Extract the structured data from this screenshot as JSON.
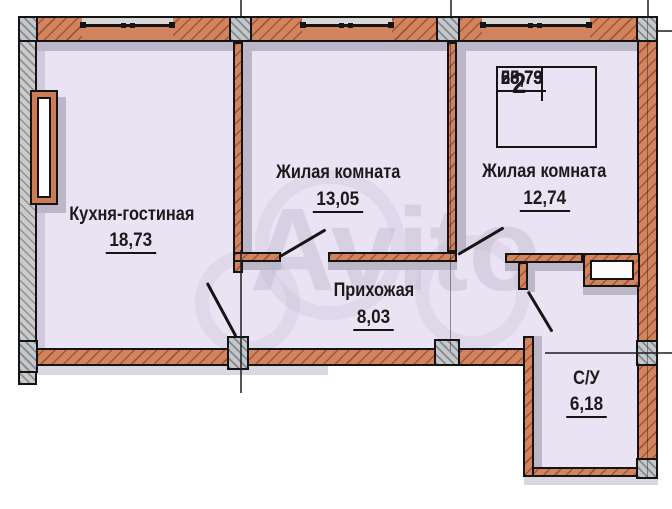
{
  "plan": {
    "title": "2-room apartment floor plan",
    "rooms": [
      {
        "name": "Кухня-гостиная",
        "area": "18,73"
      },
      {
        "name": "Жилая комната",
        "area": "13,05"
      },
      {
        "name": "Жилая комната",
        "area": "12,74"
      },
      {
        "name": "Прихожая",
        "area": "8,03"
      },
      {
        "name": "С/У",
        "area": "6,18"
      }
    ],
    "info_table": {
      "rooms_count": "2",
      "rows": [
        "25,79",
        "58,73",
        "60,73"
      ]
    },
    "watermark": "Avito",
    "colors": {
      "room_fill": "#e9e3f4",
      "wall_brick": "#d2845e",
      "wall_concrete": "#c5c8cb",
      "shadow": "#bcb6c8",
      "outline": "#141414"
    }
  }
}
